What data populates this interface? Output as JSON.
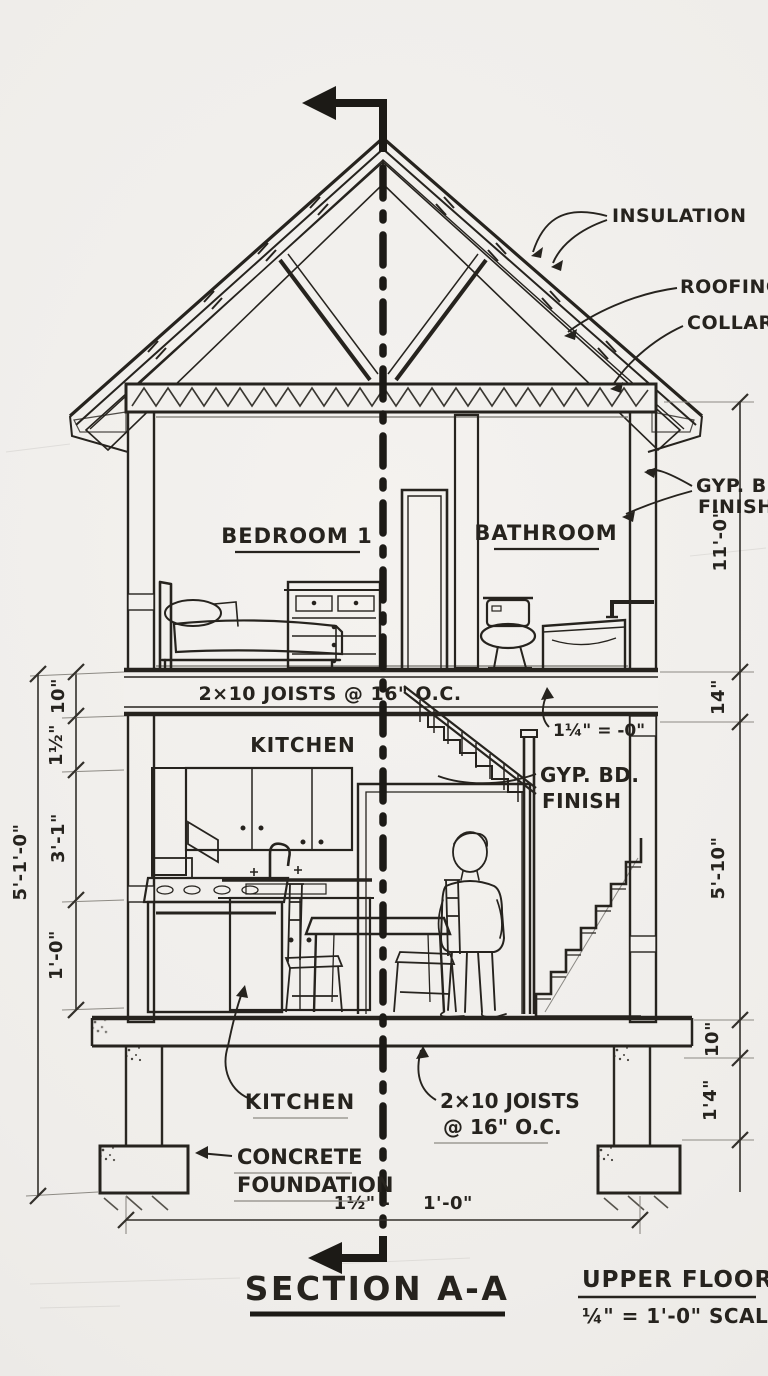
{
  "drawing": {
    "title": "SECTION A-A",
    "scale_block": {
      "line1": "UPPER FLOOR",
      "line2": "¼\" = 1'-0\" SCALE"
    }
  },
  "rooms": {
    "bedroom": "BEDROOM 1",
    "bathroom": "BATHROOM",
    "kitchen": "KITCHEN"
  },
  "notes": {
    "insulation": "INSULATION",
    "roofing": "ROOFING",
    "collar_tie": "COLLAR T",
    "gyp_upper_line1": "GYP. BD",
    "gyp_upper_line2": "FINISH",
    "floor_joists": "2×10 JOISTS @ 16\" O.C.",
    "stair_note": "1¼\" = -0\"",
    "gyp_lower_line1": "GYP. BD.",
    "gyp_lower_line2": "FINISH",
    "kitchen_callout": "KITCHEN",
    "joists_callout_line1": "2×10 JOISTS",
    "joists_callout_line2": "@ 16\" O.C.",
    "foundation_line1": "CONCRETE",
    "foundation_line2": "FOUNDATION"
  },
  "dimensions": {
    "right_room_height": "11'-0\"",
    "right_floor_band": "14\"",
    "right_first_floor": "5'-10\"",
    "right_slab": "10\"",
    "right_footing": "1'4\"",
    "left_band": "10\"",
    "left_subfloor": "1½\"",
    "left_counter": "3'-1\"",
    "left_base": "1'-0\"",
    "left_overall": "5'-1'-0\"",
    "bottom_left": "1½\" -",
    "bottom_right": "1'-0\""
  },
  "colors": {
    "paper": "#f2f0ed",
    "ink": "#26231e",
    "pencil": "#8d8a84"
  }
}
